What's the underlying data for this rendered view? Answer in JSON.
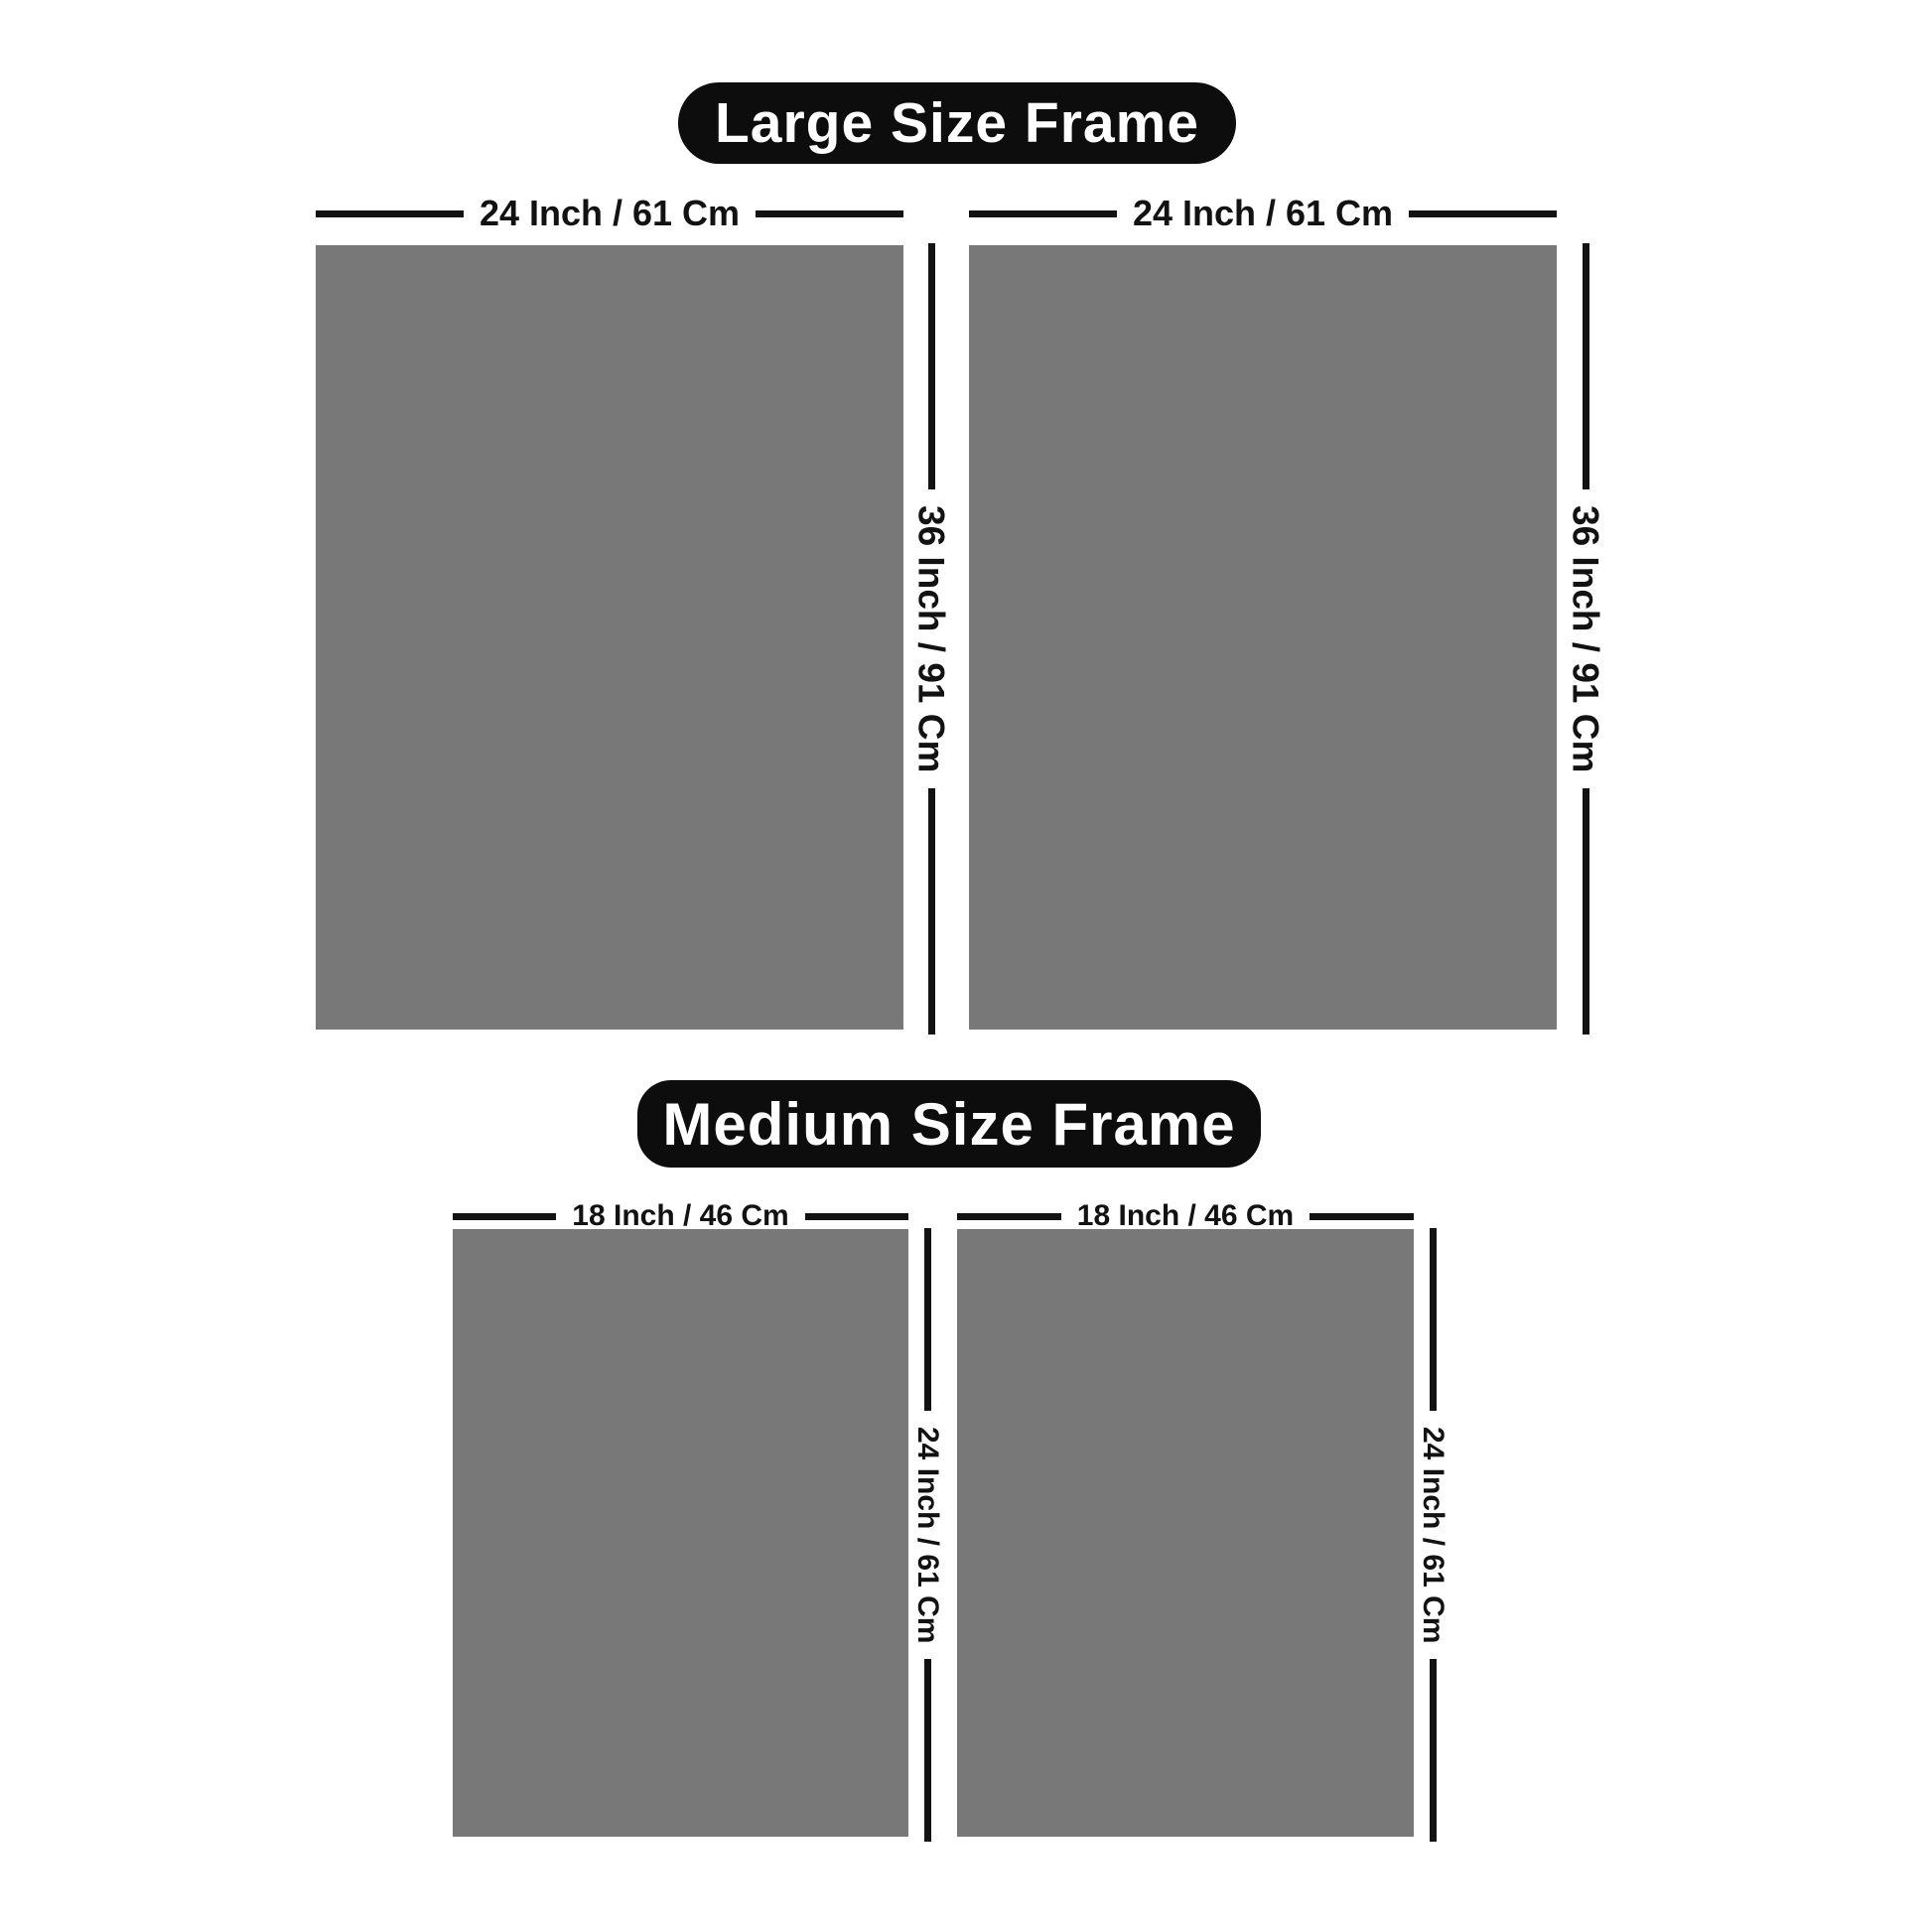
{
  "colors": {
    "background": "#ffffff",
    "badge_bg": "#0d0d0d",
    "badge_text": "#ffffff",
    "line": "#121212",
    "frame_fill": "#787878"
  },
  "sections": [
    {
      "id": "large",
      "title": "Large Size Frame",
      "width_label": "24 Inch / 61 Cm",
      "height_label": "36 Inch / 91 Cm"
    },
    {
      "id": "medium",
      "title": "Medium Size Frame",
      "width_label": "18 Inch / 46 Cm",
      "height_label": "24 Inch / 61 Cm"
    }
  ]
}
